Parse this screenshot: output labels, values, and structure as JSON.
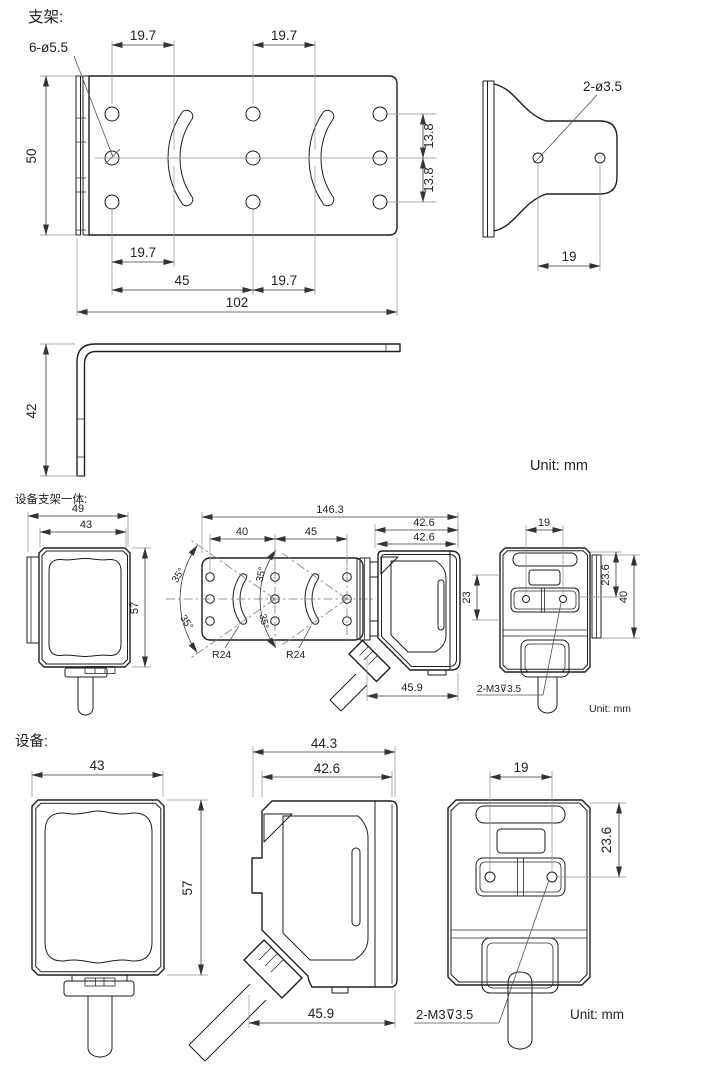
{
  "titles": {
    "bracket": "支架:",
    "integrated": "设备支架一体:",
    "device": "设备:"
  },
  "bracket": {
    "hole_callout": "6-ø5.5",
    "pitch_top_left": "19.7",
    "pitch_top_right": "19.7",
    "height": "50",
    "row_upper": "13.8",
    "row_lower": "13.8",
    "pitch_bottom_left": "19.7",
    "span_mid": "45",
    "pitch_bottom_right": "19.7",
    "total_width": "102",
    "side_hole_callout": "2-ø3.5",
    "side_hole_pitch": "19",
    "leg_height": "42",
    "unit": "Unit: mm"
  },
  "integrated": {
    "width_outer": "49",
    "width_body": "43",
    "height_body": "57",
    "total_length": "146.3",
    "hole_pitch_left": "40",
    "hole_pitch_right": "45",
    "angle_top_left": "35°",
    "angle_bottom_left": "35°",
    "angle_top_mid": "35°",
    "angle_bottom_mid": "35°",
    "slot_radius_left": "R24",
    "slot_radius_right": "R24",
    "depth_outer": "42.6",
    "depth_body": "42.6",
    "cable_clearance": "45.9",
    "rear_hole_pitch": "19",
    "rear_hole_offset": "23.6",
    "lens_height": "23",
    "plate_height": "40",
    "thread_callout": "2-M3⊽3.5",
    "unit": "Unit: mm"
  },
  "device": {
    "width_body": "43",
    "height_body": "57",
    "depth_total": "44.3",
    "depth_body": "42.6",
    "cable_clearance": "45.9",
    "rear_hole_pitch": "19",
    "rear_hole_offset": "23.6",
    "thread_callout": "2-M3⊽3.5",
    "unit": "Unit: mm"
  }
}
